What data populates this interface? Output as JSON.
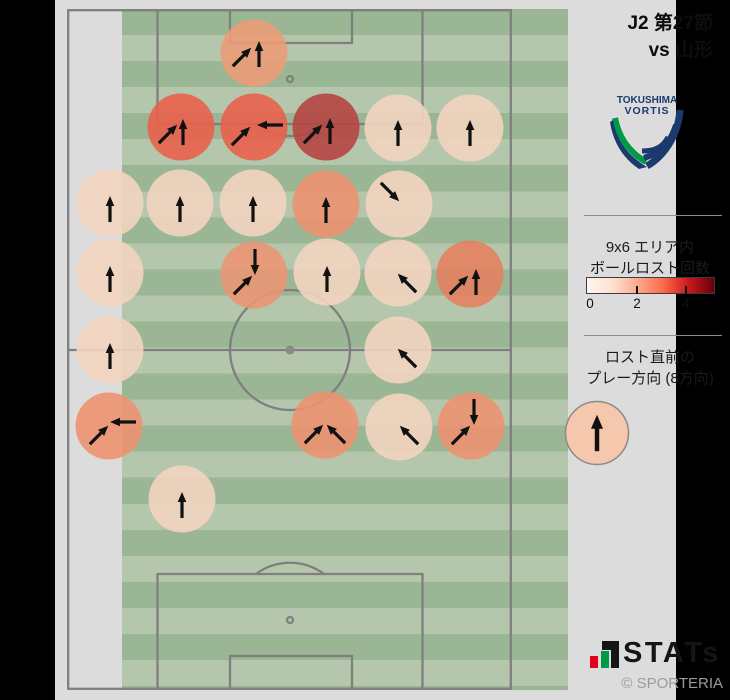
{
  "title": {
    "line1": "J2 第27節",
    "line2": "vs 山形"
  },
  "team_logo": {
    "line1": "TOKUSHIMA",
    "line2": "VORTIS",
    "navy": "#1b3a6e",
    "green": "#019a44"
  },
  "legend_count": {
    "line1": "9x6 エリア内",
    "line2": "ボールロスト回数",
    "tick_labels": [
      "0",
      "2",
      "4"
    ],
    "tick_positions_px": [
      535,
      582,
      631
    ],
    "gradient": [
      "#fff5f0",
      "#fee0d2",
      "#fcaa8d",
      "#fb6a4a",
      "#cb181d",
      "#67000d"
    ]
  },
  "legend_direction": {
    "line1": "ロスト直前の",
    "line2": "プレー方向 (8方向)",
    "example": {
      "x": 597,
      "y": 433,
      "r": 31.5,
      "fill": "#f5c7ac",
      "stroke": "#8a8a8a",
      "arrow_dir": "up"
    }
  },
  "branding": {
    "stats_text": "STATs",
    "copyright": "© SPORTERIA",
    "bar_red": "#e3001b",
    "bar_green": "#009a44",
    "bar_black": "#151515"
  },
  "pitch": {
    "stripe_dark": "#9bb694",
    "stripe_light": "#b4c6ac",
    "stripe_height_px": 26.04,
    "line_color": "#7f7f7f",
    "spot_color": "#8a8a8a"
  },
  "chart_data": {
    "type": "scatter",
    "title": "9x6 エリア内 ボールロスト回数",
    "subtitle": "ロスト直前のプレー方向 (8方向)",
    "legend_position": "right",
    "colorbar": {
      "ticks": [
        0,
        2,
        4
      ],
      "min_color": "#fff5f0",
      "max_color": "#67000d"
    },
    "circle_radius_px": 33.5,
    "circle_opacity": 0.9,
    "arrow_color": "#111111",
    "points": [
      {
        "x": 254,
        "y": 53,
        "count": 2,
        "color": "#eb9b77",
        "arrows": [
          {
            "dir": "up-right",
            "ox": -12,
            "oy": 4
          },
          {
            "dir": "up",
            "ox": 5,
            "oy": 1
          }
        ]
      },
      {
        "x": 181,
        "y": 127,
        "count": 3,
        "color": "#e9604b",
        "arrows": [
          {
            "dir": "up-right",
            "ox": -13,
            "oy": 7
          },
          {
            "dir": "up",
            "ox": 2,
            "oy": 5
          }
        ]
      },
      {
        "x": 254,
        "y": 127,
        "count": 3,
        "color": "#e9604b",
        "arrows": [
          {
            "dir": "up-right",
            "ox": -13,
            "oy": 9
          },
          {
            "dir": "left",
            "ox": 16,
            "oy": -2
          }
        ]
      },
      {
        "x": 326,
        "y": 127,
        "count": 4,
        "color": "#b64542",
        "arrows": [
          {
            "dir": "up-right",
            "ox": -13,
            "oy": 7
          },
          {
            "dir": "up",
            "ox": 4,
            "oy": 4
          }
        ]
      },
      {
        "x": 398,
        "y": 128,
        "count": 1,
        "color": "#f2d4c0",
        "arrows": [
          {
            "dir": "up",
            "ox": 0,
            "oy": 5
          }
        ]
      },
      {
        "x": 470,
        "y": 128,
        "count": 1,
        "color": "#f2d4c0",
        "arrows": [
          {
            "dir": "up",
            "ox": 0,
            "oy": 5
          }
        ]
      },
      {
        "x": 110,
        "y": 203,
        "count": 1,
        "color": "#f2d4c0",
        "arrows": [
          {
            "dir": "up",
            "ox": 0,
            "oy": 6
          }
        ]
      },
      {
        "x": 180,
        "y": 203,
        "count": 1,
        "color": "#f2d4c0",
        "arrows": [
          {
            "dir": "up",
            "ox": 0,
            "oy": 6
          }
        ]
      },
      {
        "x": 253,
        "y": 203,
        "count": 1,
        "color": "#f2d4c0",
        "arrows": [
          {
            "dir": "up",
            "ox": 0,
            "oy": 6
          }
        ]
      },
      {
        "x": 326,
        "y": 204,
        "count": 2,
        "color": "#ec9270",
        "arrows": [
          {
            "dir": "up",
            "ox": 0,
            "oy": 6
          }
        ]
      },
      {
        "x": 399,
        "y": 204,
        "count": 1,
        "color": "#f2d4c0",
        "arrows": [
          {
            "dir": "down-right",
            "ox": -9,
            "oy": -12
          }
        ]
      },
      {
        "x": 110,
        "y": 273,
        "count": 1,
        "color": "#f2d4c0",
        "arrows": [
          {
            "dir": "up",
            "ox": 0,
            "oy": 6
          }
        ]
      },
      {
        "x": 254,
        "y": 275,
        "count": 2,
        "color": "#ea9673",
        "arrows": [
          {
            "dir": "down",
            "ox": 1,
            "oy": -13
          },
          {
            "dir": "up-right",
            "ox": -11,
            "oy": 10
          }
        ]
      },
      {
        "x": 327,
        "y": 272,
        "count": 1,
        "color": "#f2d4c0",
        "arrows": [
          {
            "dir": "up",
            "ox": 0,
            "oy": 7
          }
        ]
      },
      {
        "x": 398,
        "y": 273,
        "count": 1,
        "color": "#f2d4c0",
        "arrows": [
          {
            "dir": "up-left",
            "ox": 9,
            "oy": 10
          }
        ]
      },
      {
        "x": 470,
        "y": 274,
        "count": 2,
        "color": "#e4815f",
        "arrows": [
          {
            "dir": "up-right",
            "ox": -11,
            "oy": 11
          },
          {
            "dir": "up",
            "ox": 6,
            "oy": 8
          }
        ]
      },
      {
        "x": 110,
        "y": 350,
        "count": 1,
        "color": "#f2d4c0",
        "arrows": [
          {
            "dir": "up",
            "ox": 0,
            "oy": 6
          }
        ]
      },
      {
        "x": 398,
        "y": 350,
        "count": 1,
        "color": "#f2d4c0",
        "arrows": [
          {
            "dir": "up-left",
            "ox": 9,
            "oy": 8
          }
        ]
      },
      {
        "x": 109,
        "y": 426,
        "count": 2,
        "color": "#ec9270",
        "arrows": [
          {
            "dir": "left",
            "ox": 14,
            "oy": -4
          },
          {
            "dir": "up-right",
            "ox": -10,
            "oy": 9
          }
        ]
      },
      {
        "x": 325,
        "y": 425,
        "count": 2,
        "color": "#ec9270",
        "arrows": [
          {
            "dir": "up-right",
            "ox": -11,
            "oy": 9
          },
          {
            "dir": "up-left",
            "ox": 11,
            "oy": 9
          }
        ]
      },
      {
        "x": 399,
        "y": 427,
        "count": 1,
        "color": "#f2d4c0",
        "arrows": [
          {
            "dir": "up-left",
            "ox": 10,
            "oy": 8
          }
        ]
      },
      {
        "x": 471,
        "y": 426,
        "count": 2,
        "color": "#ec9270",
        "arrows": [
          {
            "dir": "down",
            "ox": 3,
            "oy": -14
          },
          {
            "dir": "up-right",
            "ox": -10,
            "oy": 9
          }
        ]
      },
      {
        "x": 182,
        "y": 499,
        "count": 1,
        "color": "#f2d4c0",
        "arrows": [
          {
            "dir": "up",
            "ox": 0,
            "oy": 6
          }
        ]
      }
    ]
  }
}
